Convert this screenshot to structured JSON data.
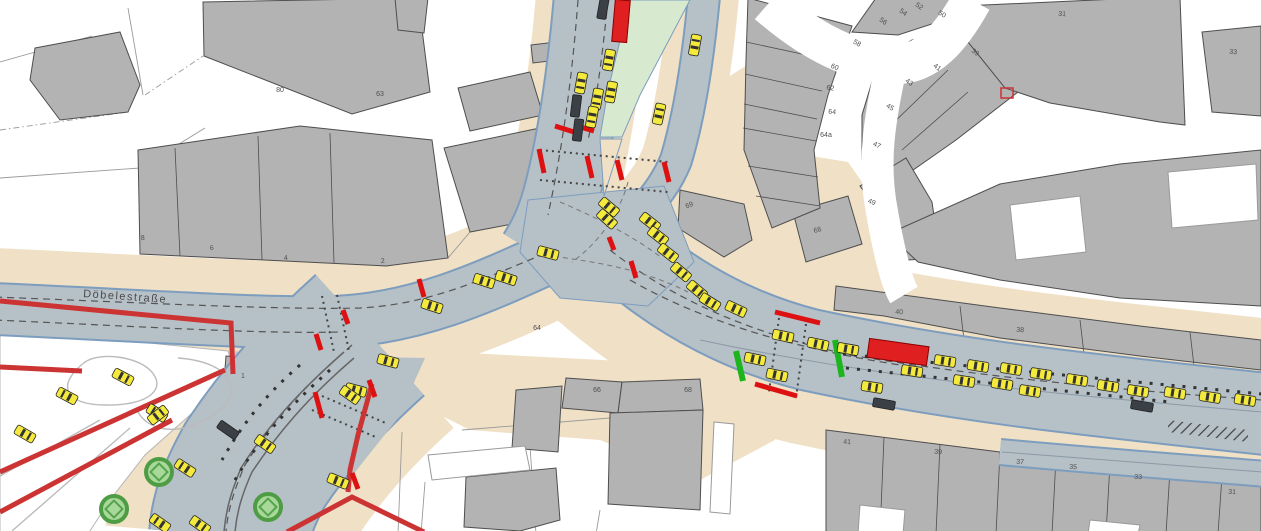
{
  "street_label": "Döbelestraße",
  "colors": {
    "road": "#b6c0c7",
    "road_edge": "#7d9dbe",
    "sidewalk": "#efe0c6",
    "building": "#b3b3b3",
    "building_outline": "#4e4e4e",
    "median_green": "#d7ead0",
    "vehicle_yellow": "#f4ea3d",
    "vehicle_dark": "#3a4045",
    "bus_red": "#e02020",
    "signal_red": "#dd1111",
    "signal_green": "#1db51d",
    "planned_outline_red": "#cc3333",
    "tree_green": "#4e9d45"
  },
  "building_numbers": [
    {
      "label": "80",
      "x": 280,
      "y": 92,
      "rot": 0
    },
    {
      "label": "63",
      "x": 380,
      "y": 96,
      "rot": 0
    },
    {
      "label": "8",
      "x": 143,
      "y": 240,
      "rot": -4
    },
    {
      "label": "6",
      "x": 212,
      "y": 250,
      "rot": -4
    },
    {
      "label": "4",
      "x": 286,
      "y": 260,
      "rot": -4
    },
    {
      "label": "2",
      "x": 383,
      "y": 263,
      "rot": -4
    },
    {
      "label": "1",
      "x": 243,
      "y": 378,
      "rot": 0
    },
    {
      "label": "64",
      "x": 537,
      "y": 330,
      "rot": 0
    },
    {
      "label": "66",
      "x": 597,
      "y": 392,
      "rot": 0
    },
    {
      "label": "68",
      "x": 688,
      "y": 392,
      "rot": 0
    },
    {
      "label": "69",
      "x": 690,
      "y": 207,
      "rot": -20
    },
    {
      "label": "68",
      "x": 818,
      "y": 232,
      "rot": -15
    },
    {
      "label": "54",
      "x": 902,
      "y": 14,
      "rot": 35
    },
    {
      "label": "56",
      "x": 882,
      "y": 23,
      "rot": 35
    },
    {
      "label": "52",
      "x": 918,
      "y": 8,
      "rot": 35
    },
    {
      "label": "50",
      "x": 941,
      "y": 16,
      "rot": 30
    },
    {
      "label": "58",
      "x": 856,
      "y": 45,
      "rot": 30
    },
    {
      "label": "60",
      "x": 834,
      "y": 69,
      "rot": 20
    },
    {
      "label": "62",
      "x": 830,
      "y": 90,
      "rot": 10
    },
    {
      "label": "64",
      "x": 832,
      "y": 114,
      "rot": 5
    },
    {
      "label": "64a",
      "x": 826,
      "y": 137,
      "rot": 0
    },
    {
      "label": "47",
      "x": 876,
      "y": 147,
      "rot": 25
    },
    {
      "label": "45",
      "x": 889,
      "y": 109,
      "rot": 30
    },
    {
      "label": "43",
      "x": 908,
      "y": 84,
      "rot": 35
    },
    {
      "label": "41",
      "x": 936,
      "y": 69,
      "rot": 35
    },
    {
      "label": "39",
      "x": 974,
      "y": 54,
      "rot": 35
    },
    {
      "label": "49",
      "x": 871,
      "y": 204,
      "rot": 20
    },
    {
      "label": "31",
      "x": 1062,
      "y": 16,
      "rot": 4
    },
    {
      "label": "33",
      "x": 1233,
      "y": 54,
      "rot": 4
    },
    {
      "label": "40",
      "x": 899,
      "y": 314,
      "rot": 4
    },
    {
      "label": "38",
      "x": 1020,
      "y": 332,
      "rot": 4
    },
    {
      "label": "41",
      "x": 847,
      "y": 444,
      "rot": 3
    },
    {
      "label": "39",
      "x": 938,
      "y": 454,
      "rot": 3
    },
    {
      "label": "37",
      "x": 1020,
      "y": 464,
      "rot": 3
    },
    {
      "label": "35",
      "x": 1073,
      "y": 469,
      "rot": 3
    },
    {
      "label": "33",
      "x": 1138,
      "y": 479,
      "rot": 3
    },
    {
      "label": "31",
      "x": 1232,
      "y": 494,
      "rot": 3
    }
  ],
  "vehicles": {
    "cars": [
      [
        609,
        60,
        100
      ],
      [
        611,
        92,
        100
      ],
      [
        581,
        83,
        100
      ],
      [
        597,
        99,
        100
      ],
      [
        592,
        117,
        100
      ],
      [
        695,
        45,
        -80
      ],
      [
        659,
        114,
        -78
      ],
      [
        609,
        207,
        40
      ],
      [
        607,
        219,
        42
      ],
      [
        548,
        253,
        15
      ],
      [
        506,
        278,
        18
      ],
      [
        484,
        281,
        18
      ],
      [
        432,
        306,
        18
      ],
      [
        388,
        361,
        15
      ],
      [
        356,
        390,
        15
      ],
      [
        650,
        222,
        38
      ],
      [
        658,
        236,
        38
      ],
      [
        668,
        253,
        38
      ],
      [
        681,
        272,
        40
      ],
      [
        697,
        290,
        40
      ],
      [
        710,
        302,
        32
      ],
      [
        736,
        309,
        25
      ],
      [
        755,
        359,
        12
      ],
      [
        777,
        375,
        12
      ],
      [
        783,
        336,
        12
      ],
      [
        818,
        344,
        12
      ],
      [
        848,
        349,
        10
      ],
      [
        872,
        387,
        9
      ],
      [
        912,
        371,
        9
      ],
      [
        945,
        361,
        9
      ],
      [
        964,
        381,
        9
      ],
      [
        978,
        366,
        9
      ],
      [
        1002,
        384,
        9
      ],
      [
        1011,
        369,
        9
      ],
      [
        1030,
        391,
        9
      ],
      [
        1041,
        374,
        9
      ],
      [
        1077,
        380,
        9
      ],
      [
        1108,
        386,
        9
      ],
      [
        1138,
        391,
        9
      ],
      [
        1175,
        393,
        9
      ],
      [
        1210,
        397,
        9
      ],
      [
        1245,
        400,
        9
      ],
      [
        157,
        413,
        212
      ],
      [
        185,
        468,
        213
      ],
      [
        265,
        444,
        35
      ],
      [
        350,
        395,
        35
      ],
      [
        338,
        481,
        22
      ],
      [
        160,
        523,
        215
      ],
      [
        200,
        525,
        35
      ],
      [
        123,
        377,
        28
      ],
      [
        67,
        396,
        208
      ],
      [
        158,
        415,
        322
      ],
      [
        25,
        434,
        30
      ]
    ],
    "dark_vehicles": [
      [
        603,
        8,
        100
      ],
      [
        576,
        106,
        97
      ],
      [
        578,
        130,
        97
      ],
      [
        228,
        430,
        35
      ],
      [
        884,
        404,
        10
      ],
      [
        1142,
        406,
        10
      ]
    ],
    "red_vehicles": [
      {
        "x": 621,
        "y": 21,
        "w": 15,
        "h": 42,
        "rot": 5
      },
      {
        "x": 898,
        "y": 352,
        "w": 60,
        "h": 19,
        "rot": 8
      }
    ]
  },
  "signals": {
    "red": [
      [
        419,
        279,
        424,
        297
      ],
      [
        343,
        310,
        348,
        324
      ],
      [
        316,
        334,
        321,
        350
      ],
      [
        315,
        392,
        322,
        418
      ],
      [
        369,
        380,
        375,
        397
      ],
      [
        352,
        473,
        358,
        489
      ],
      [
        539,
        149,
        544,
        173
      ],
      [
        587,
        156,
        592,
        178
      ],
      [
        617,
        160,
        622,
        180
      ],
      [
        664,
        162,
        669,
        182
      ],
      [
        555,
        126,
        574,
        132
      ],
      [
        577,
        126,
        594,
        131
      ],
      [
        609,
        237,
        614,
        250
      ],
      [
        631,
        261,
        636,
        278
      ],
      [
        775,
        312,
        820,
        323
      ],
      [
        755,
        384,
        797,
        396
      ]
    ],
    "green": [
      [
        736,
        351,
        743,
        381
      ],
      [
        835,
        340,
        842,
        377
      ]
    ]
  },
  "trees": [
    [
      159,
      472
    ],
    [
      114,
      509
    ],
    [
      268,
      507
    ]
  ]
}
